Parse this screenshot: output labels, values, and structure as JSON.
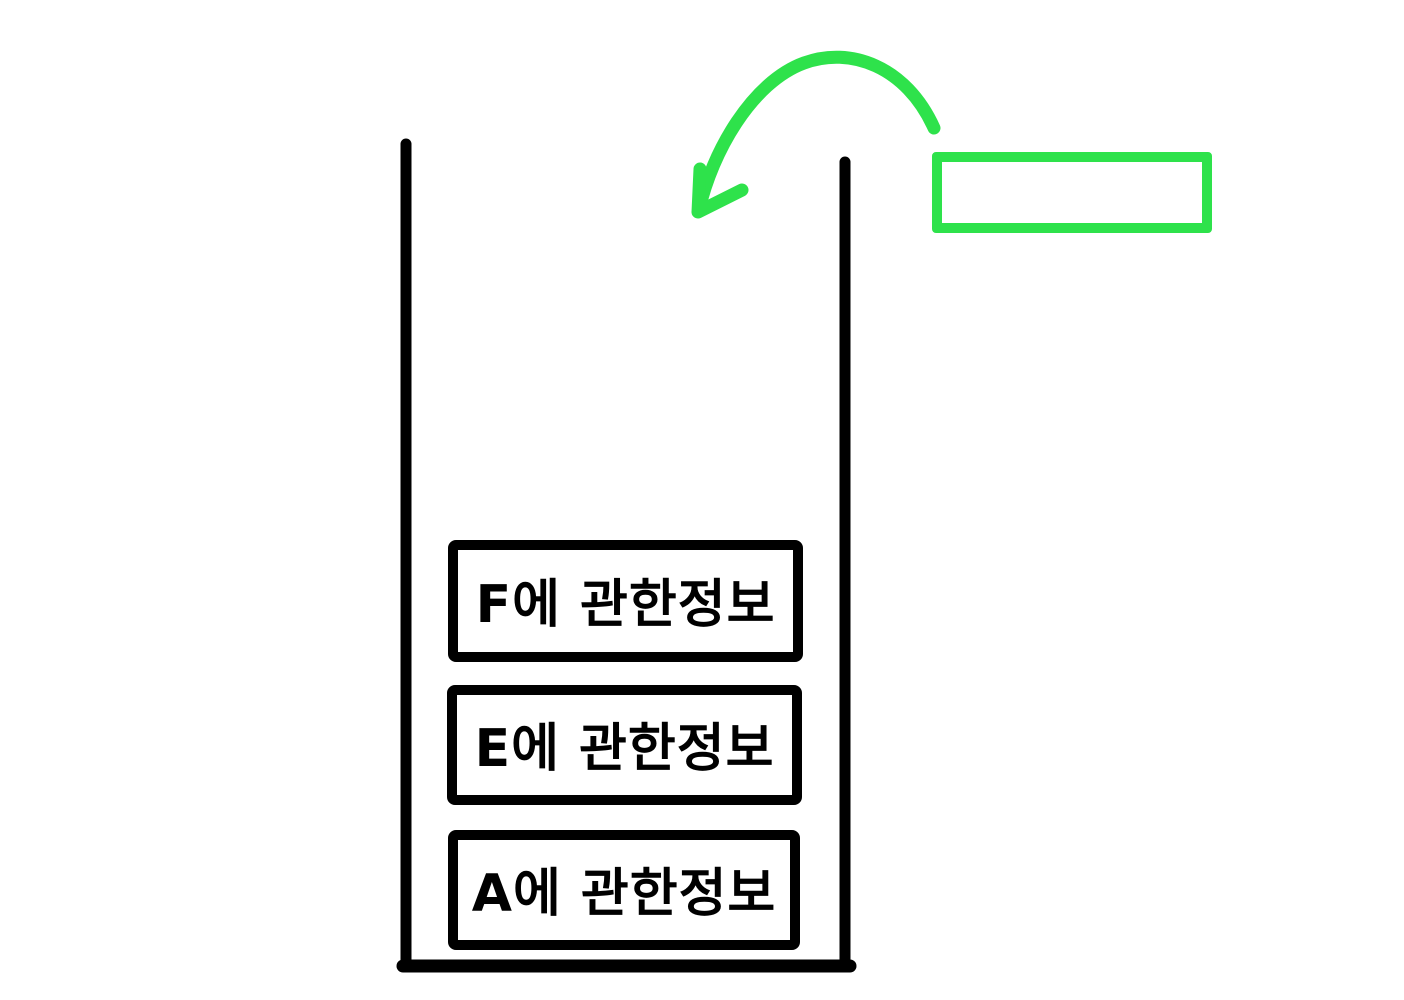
{
  "diagram": {
    "colors": {
      "ink": "#000000",
      "accent_green": "#2ee24b",
      "background": "#ffffff"
    },
    "stack": {
      "items": [
        {
          "label": "F에 관한정보"
        },
        {
          "label": "E에 관한정보"
        },
        {
          "label": "A에 관한정보"
        }
      ]
    },
    "incoming_item": {
      "label": ""
    }
  }
}
